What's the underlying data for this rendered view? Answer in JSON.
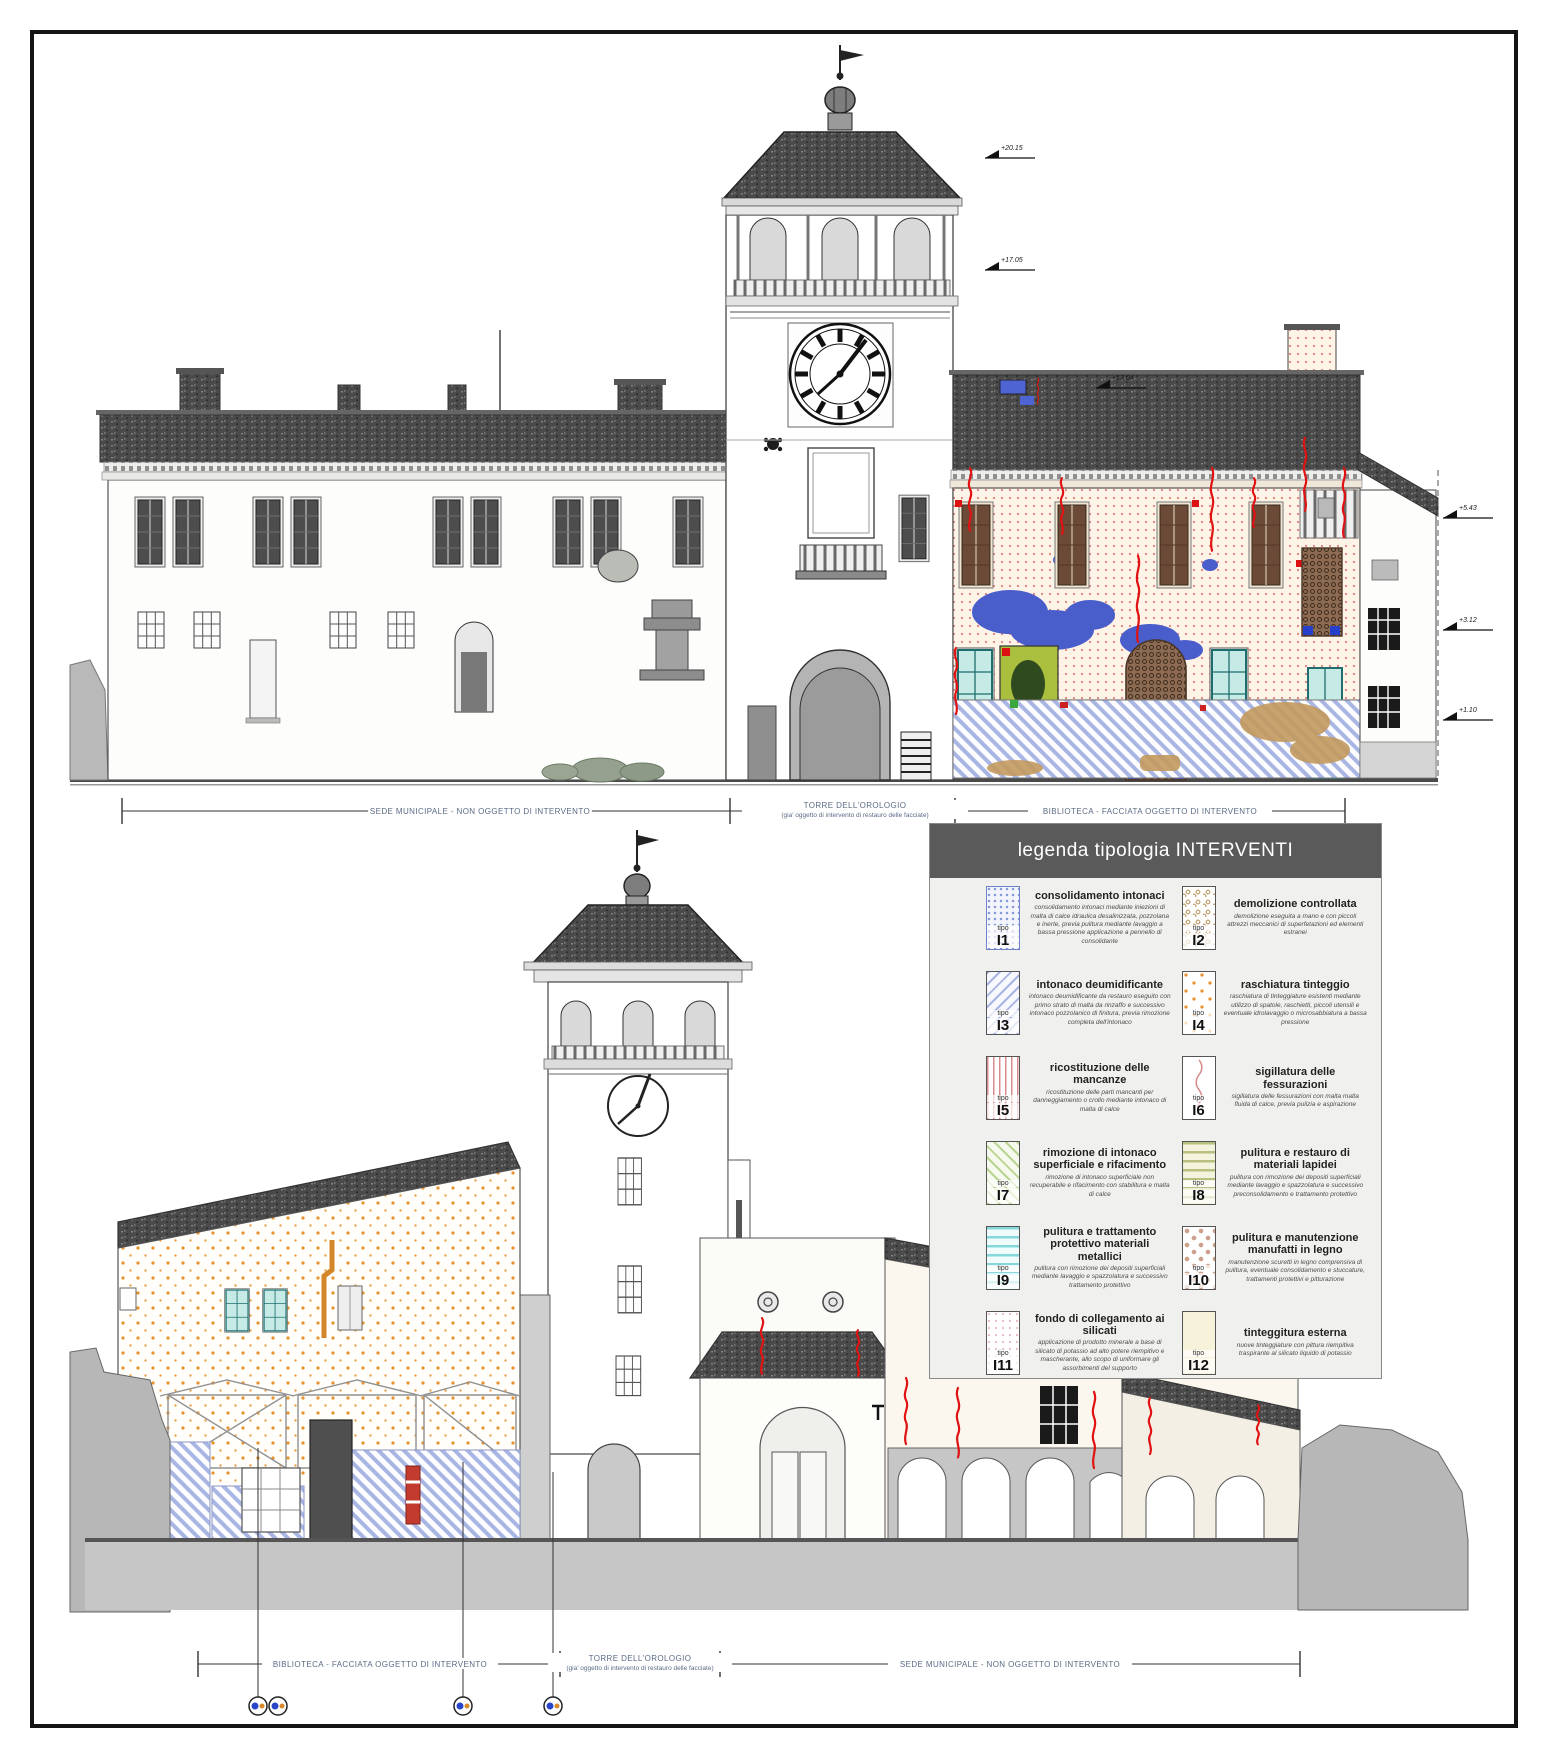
{
  "legend": {
    "title": "legenda tipologia INTERVENTI",
    "tipo_label": "tipo",
    "entries": [
      {
        "code": "I1",
        "title": "consolidamento intonaci",
        "desc": "consolidamento intonaci mediante iniezioni di malta di calce idraulica desalinizzata, pozzolana e inerte, previa pulitura mediante lavaggio a bassa pressione applicazione a pennello di consolidante"
      },
      {
        "code": "I2",
        "title": "demolizione controllata",
        "desc": "demolizione eseguita a mano e con piccoli attrezzi meccanici di superfetazioni ed elementi estranei"
      },
      {
        "code": "I3",
        "title": "intonaco deumidificante",
        "desc": "intonaco deumidificante da restauro eseguito con primo strato di malta da rinzaffo e successivo intonaco pozzolanico di finitura, previa rimozione completa dell'intonaco"
      },
      {
        "code": "I4",
        "title": "raschiatura tinteggio",
        "desc": "raschiatura di tinteggiature esistenti mediante utilizzo di spatole, raschietti, piccoli utensili e eventuale idrolavaggio o microsabbiatura a bassa pressione"
      },
      {
        "code": "I5",
        "title": "ricostituzione delle mancanze",
        "desc": "ricostituzione delle parti mancanti per danneggiamento o crollo mediante intonaco di malta di calce"
      },
      {
        "code": "I6",
        "title": "sigillatura delle fessurazioni",
        "desc": "sigillatura delle fessurazioni con malta malta fluida di calce, previa pulizia e aspirazione"
      },
      {
        "code": "I7",
        "title": "rimozione di intonaco superficiale e rifacimento",
        "desc": "rimozione di intonaco superficiale non recuperabile e rifacimento con stabilitura e malta di calce"
      },
      {
        "code": "I8",
        "title": "pulitura e restauro di materiali lapidei",
        "desc": "pulitura con rimozione dei depositi superficiali mediante lavaggio e spazzolatura e successivo preconsolidamento e trattamento protettivo"
      },
      {
        "code": "I9",
        "title": "pulitura e trattamento protettivo materiali metallici",
        "desc": "pulitura con rimozione dei depositi superficiali mediante lavaggio e spazzolatura e successivo trattamento protettivo"
      },
      {
        "code": "I10",
        "title": "pulitura e manutenzione manufatti in legno",
        "desc": "manutenzione scuretti in legno comprensiva di pulitura, eventuale consolidamento e stuccature, trattamenti protettivi e pitturazione"
      },
      {
        "code": "I11",
        "title": "fondo di collegamento ai silicati",
        "desc": "applicazione di prodotto minerale a base di silicato di potassio ad alto potere riempitivo e mascherante, allo scopo di uniformare gli assorbimenti del supporto"
      },
      {
        "code": "I12",
        "title": "tinteggitura esterna",
        "desc": "nuove tinteggiature con pittura riempitiva traspirante al silicato liquido di potassio"
      }
    ]
  },
  "top_elevation": {
    "label_left": "SEDE MUNICIPALE - NON OGGETTO DI INTERVENTO",
    "label_center_1": "TORRE DELL'OROLOGIO",
    "label_center_2": "(gia' oggetto di intervento di restauro delle facciate)",
    "label_right": "BIBLIOTECA - FACCIATA OGGETTO DI INTERVENTO",
    "quotas": {
      "tower_top": "+20.15",
      "tower_belfry": "+17.05",
      "roof_right": "+13.04",
      "eave": "+5.43",
      "floor": "+3.12",
      "base": "+1.10"
    }
  },
  "bottom_elevation": {
    "label_left": "BIBLIOTECA - FACCIATA OGGETTO DI INTERVENTO",
    "label_center_1": "TORRE DELL'OROLOGIO",
    "label_center_2": "(gia' oggetto di intervento di restauro delle facciate)",
    "label_right": "SEDE MUNICIPALE - NON OGGETTO DI INTERVENTO"
  },
  "colors": {
    "legend_header": "#5a5a5a",
    "crack_red": "#e01212",
    "blob_blue": "#4a5ecb",
    "hatch_blue": "#a9b6e4",
    "dots_orange": "#e8932c",
    "teal_window": "#c6ebe7"
  }
}
